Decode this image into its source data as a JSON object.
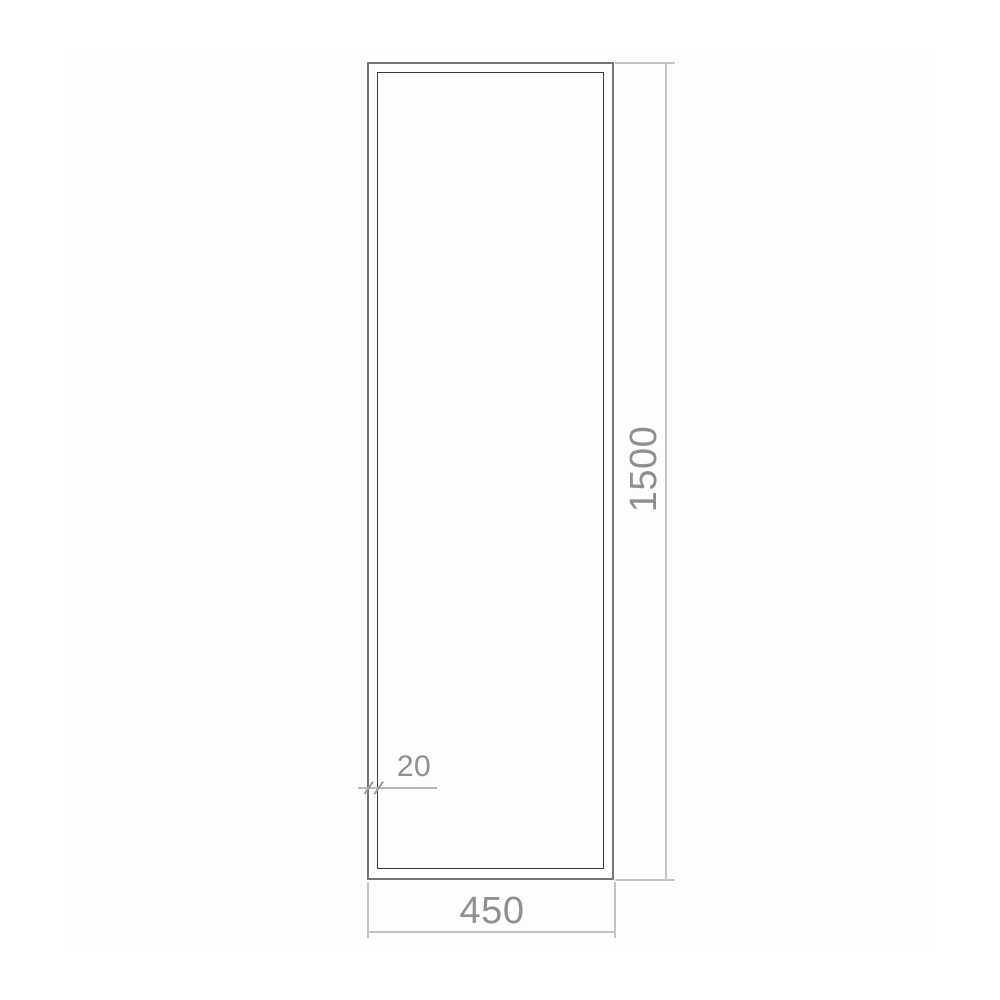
{
  "drawing": {
    "type": "technical-dimension-drawing",
    "subject": "tall rectangular frame, front elevation",
    "dimensions": {
      "height_label": "1500",
      "width_label": "450",
      "frame_thickness_label": "20"
    },
    "colors": {
      "background": "#ffffff",
      "canvas_panel": "#fdfdfd",
      "outer_frame_line": "#757575",
      "inner_frame_line": "#383838",
      "dimension_line": "#c3c3c3",
      "tick_mark": "#9a9a9a",
      "dimension_text": "#8f8f8f"
    }
  }
}
